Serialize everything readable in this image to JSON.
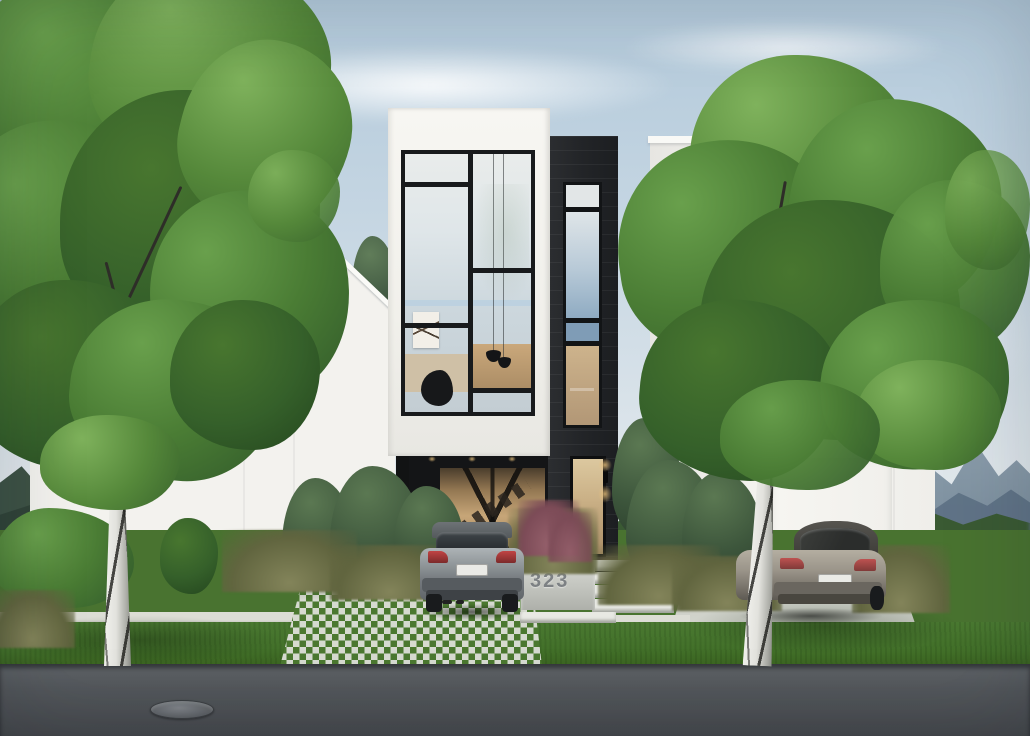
{
  "house": {
    "number": "323"
  },
  "palette": {
    "sky_top": "#b2c9da",
    "sky_horizon": "#eceff0",
    "cloud_white": "#f4f7f8",
    "facade_white": "#f3f2ee",
    "facade_shadow": "#e0dfda",
    "cladding_dark": "#232528",
    "window_frame_black": "#181a1c",
    "glass_reflection_blue": "#c3cdd3",
    "interior_warm_light": "#c7a678",
    "foliage_dark": "#2c4f22",
    "foliage_mid": "#4a7c34",
    "foliage_light": "#7fb25c",
    "conifer_green": "#3d563c",
    "lawn_green": "#57933b",
    "verge_green": "#427029",
    "ornamental_grass_olive": "#7c7d54",
    "grass_plume_red": "#8d5663",
    "pavement_light": "#d6dad0",
    "road_asphalt": "#53575b",
    "mountain_haze_blue": "#7b8e9d",
    "mountain_dark_green": "#3d5245",
    "birch_bark_white": "#e2e2dd",
    "car_gray": "#8e9497",
    "car_champagne": "#9b958a",
    "taillight_red": "#c14444",
    "house_number_gray": "#7d8184"
  },
  "objects": {
    "center_house": "modern-white-house",
    "left_house": "white-gable-house",
    "right_house": "white-flat-roof-house",
    "car_center": "gray-hatchback",
    "car_right": "champagne-sedan",
    "tree_left": "birch-tree",
    "tree_right": "birch-tree",
    "street": "asphalt-road",
    "manhole": "manhole-cover"
  }
}
